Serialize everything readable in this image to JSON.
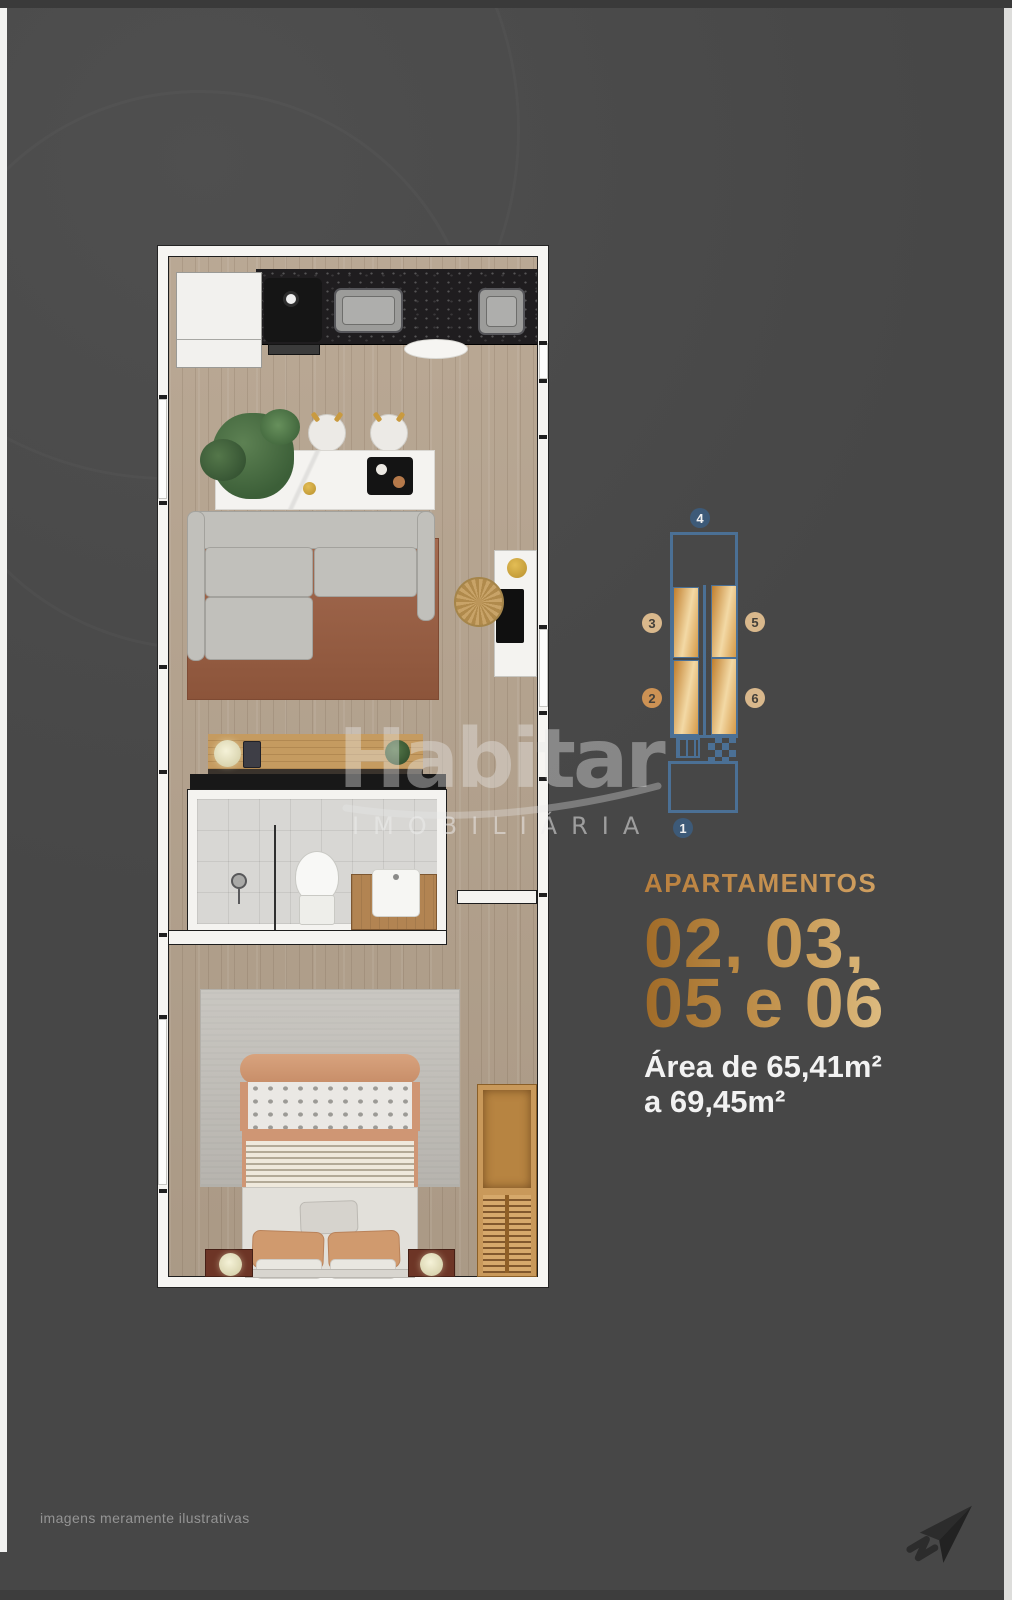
{
  "page": {
    "background_color": "#474747",
    "disclaimer": "imagens meramente ilustrativas"
  },
  "watermark": {
    "brand": "Habitar",
    "subtitle": "IMOBILIÁRIA"
  },
  "unit_diagram": {
    "badges": {
      "top": "4",
      "left_upper": "3",
      "right_upper": "5",
      "left_lower": "2",
      "right_lower": "6",
      "bottom": "1"
    },
    "outline_color": "#4b7095",
    "badge_blue": "#3d5a78",
    "badge_tan": "#d9b88c",
    "badge_orange": "#cd9254",
    "unit_gold_dark": "#c07e2e",
    "unit_gold_light": "#f3d9a5"
  },
  "info_panel": {
    "heading": "APARTAMENTOS",
    "units_line1": "02, 03,",
    "units_line2": "05 e 06",
    "area_line1": "Área de 65,41m²",
    "area_line2": "a 69,45m²",
    "heading_color": "#c9965a",
    "gold_gradient_start": "#a06b28",
    "gold_gradient_end": "#f2dcab",
    "area_text_color": "#f2f2f2"
  },
  "icons": {
    "send_icon": "paper-plane-with-trail"
  }
}
